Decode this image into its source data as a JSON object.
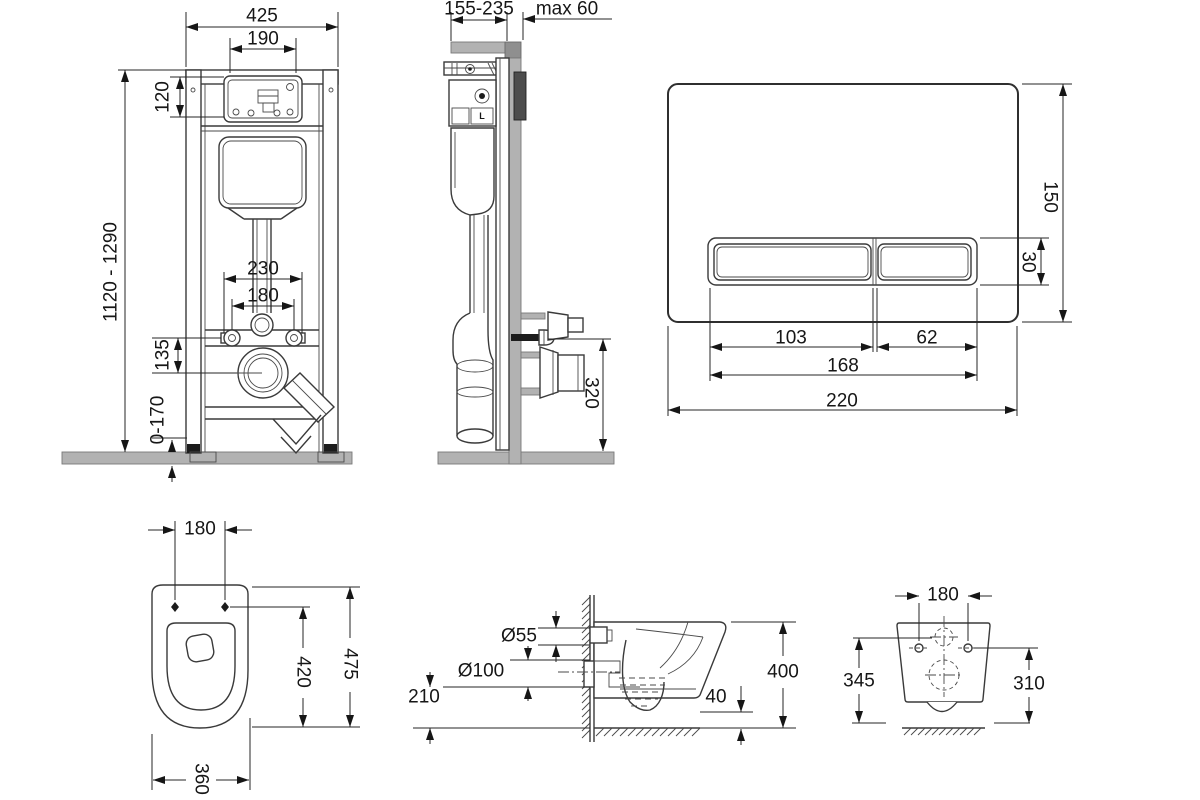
{
  "views": {
    "installation_front": {
      "dims": {
        "total_width": "425",
        "opening_width": "190",
        "opening_height": "120",
        "frame_height": "1120 - 1290",
        "fixing_width_outer": "230",
        "fixing_width_inner": "180",
        "outlet_drop": "135",
        "foot_adjust": "0-170"
      }
    },
    "installation_side": {
      "dims": {
        "depth_range": "155-235",
        "wall_max": "max 60",
        "outlet_height": "320"
      },
      "mechanism_label": "L"
    },
    "flush_plate": {
      "dims": {
        "height": "150",
        "button_height": "30",
        "large_button_width": "103",
        "small_button_width": "62",
        "buttons_width": "168",
        "width": "220"
      }
    },
    "bowl_top": {
      "dims": {
        "fixing_spacing": "180",
        "inner_depth": "420",
        "total_depth": "475",
        "width": "360"
      }
    },
    "bowl_side": {
      "dims": {
        "inlet_diameter": "Ø55",
        "outlet_diameter": "Ø100",
        "outlet_axis_height": "210",
        "rim_drop": "40",
        "rim_height": "400"
      }
    },
    "bowl_rear": {
      "dims": {
        "fixing_spacing": "180",
        "inlet_height": "345",
        "fixing_height": "310"
      }
    }
  }
}
